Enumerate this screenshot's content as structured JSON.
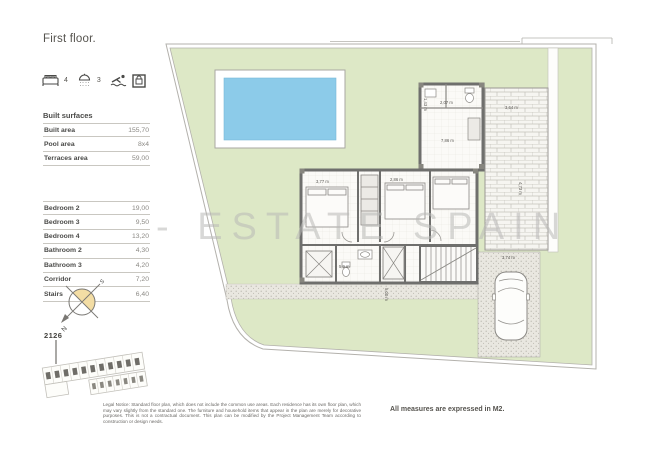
{
  "header": {
    "title": "First floor."
  },
  "amenities": {
    "bedrooms": {
      "icon": "bed-icon",
      "count": "4"
    },
    "bathrooms": {
      "icon": "shower-icon",
      "count": "3"
    },
    "pool": {
      "icon": "pool-icon"
    },
    "safe": {
      "icon": "safe-icon"
    }
  },
  "surfaces": {
    "title": "Built surfaces",
    "main_rows": [
      {
        "label": "Built area",
        "value": "155,70"
      },
      {
        "label": "Pool area",
        "value": "8x4"
      },
      {
        "label": "Terraces area",
        "value": "59,00"
      }
    ],
    "room_rows": [
      {
        "label": "Bedroom 2",
        "value": "19,00"
      },
      {
        "label": "Bedroom 3",
        "value": "9,50"
      },
      {
        "label": "Bedroom 4",
        "value": "13,20"
      },
      {
        "label": "Bathroom 2",
        "value": "4,30"
      },
      {
        "label": "Bathroom 3",
        "value": "4,20"
      },
      {
        "label": "Corridor",
        "value": "7,20"
      },
      {
        "label": "Stairs",
        "value": "6,40"
      }
    ]
  },
  "compass": {
    "north": "N",
    "south": "S"
  },
  "site": {
    "plot_number": "2126"
  },
  "plan": {
    "watermark": "- ESTATE SPAIN",
    "dimensions": [
      "3,77 m",
      "2,86 m",
      "3,64 m",
      "4,73 m",
      "3,74 m",
      "2,07 m",
      "1,43 m",
      "7,86 m",
      "5,9 m",
      "5,00 m"
    ]
  },
  "footer": {
    "legal_notice": "Legal Notice: Standard floor plan, which does not include the common use areas. Each residence has its own floor plan, which may vary slightly from the standard one. The furniture and household items that appear in the plan are merely for decorative purposes. This is not a contractual document. This plan can be modified by the Project Management Team according to construction or design needs.",
    "measures_note": "All measures are expressed in M2."
  },
  "colors": {
    "lawn": "#dde8c6",
    "pool": "#8ccbe9",
    "wall": "#6f6f6d",
    "compass_fill": "#f3dda4"
  }
}
